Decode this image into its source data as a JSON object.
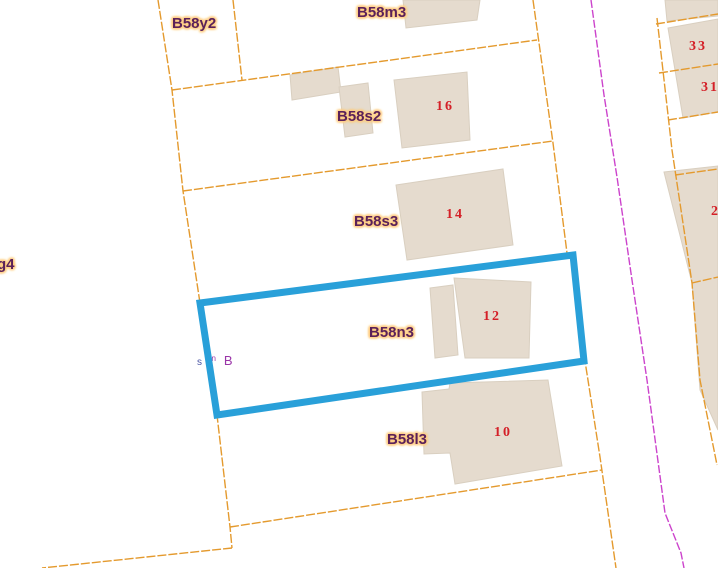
{
  "map": {
    "type": "cadastral-map-view",
    "selected_parcel": "B58n3"
  },
  "parcel_labels": {
    "g4": "g4",
    "y2": "B58y2",
    "m3": "B58m3",
    "s2": "B58s2",
    "s3": "B58s3",
    "n3": "B58n3",
    "l3": "B58l3"
  },
  "house_numbers": {
    "h16": "16",
    "h14": "14",
    "h12": "12",
    "h10": "10",
    "h33": "33",
    "h31": "31",
    "h2": "2"
  },
  "annotation": {
    "s": "s",
    "sup": "pn",
    "b": "B"
  },
  "colors": {
    "background": "#ffffff",
    "parcel_line": "#e49a2e",
    "building_fill": "#e5dbce",
    "building_edge": "#d9cfc0",
    "selection_outline": "#29a0d9",
    "boundary_magenta": "#cc44cc",
    "parcel_label_text": "#5b2159",
    "parcel_label_halo": "#ffce85",
    "house_number_text": "#d42028",
    "annotation_purple": "#9a35a8",
    "annotation_blue": "#4a55a5"
  }
}
